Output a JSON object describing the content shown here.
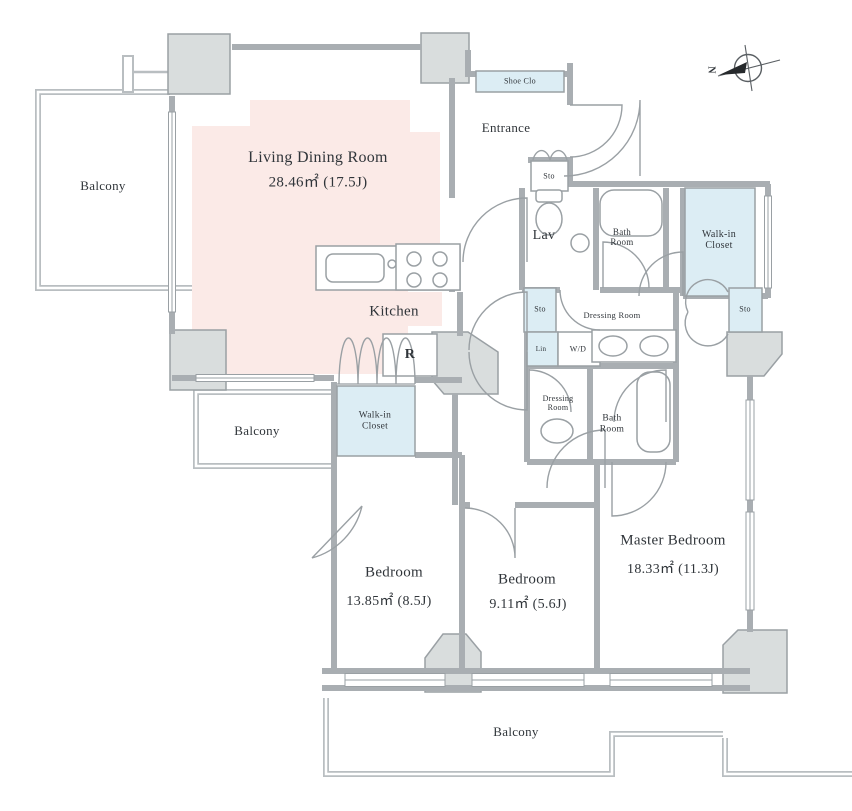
{
  "compass": {
    "north_label": "N"
  },
  "rooms": {
    "living_dining": {
      "name": "Living Dining Room",
      "area": "28.46㎡ (17.5J)"
    },
    "kitchen": {
      "name": "Kitchen"
    },
    "refrigerator": {
      "name": "R"
    },
    "entrance": {
      "name": "Entrance"
    },
    "shoe_closet": {
      "name": "Shoe Clo"
    },
    "lavatory": {
      "name": "Lav"
    },
    "bathroom_upper": {
      "name": "Bath Room"
    },
    "bathroom_lower": {
      "name": "Bath Room"
    },
    "walkin_closet_master": {
      "name": "Walk-in Closet"
    },
    "walkin_closet_bedroom": {
      "name": "Walk-in Closet"
    },
    "dressing_room_upper": {
      "name": "Dressing Room"
    },
    "dressing_room_lower": {
      "name": "Dressing Room"
    },
    "linen": {
      "name": "Lin"
    },
    "washer_dryer": {
      "name": "W/D"
    },
    "storage_entrance": {
      "name": "Sto"
    },
    "storage_hall": {
      "name": "Sto"
    },
    "storage_master": {
      "name": "Sto"
    },
    "bedroom_1": {
      "name": "Bedroom",
      "area": "13.85㎡ (8.5J)"
    },
    "bedroom_2": {
      "name": "Bedroom",
      "area": "9.11㎡ (5.6J)"
    },
    "master_bedroom": {
      "name": "Master Bedroom",
      "area": "18.33㎡ (11.3J)"
    },
    "balcony_left": {
      "name": "Balcony"
    },
    "balcony_middle": {
      "name": "Balcony"
    },
    "balcony_bottom": {
      "name": "Balcony"
    }
  },
  "colors": {
    "floor_pink": "#fbeae7",
    "closet_blue": "#dcedf4",
    "wall_gray": "#a9aeb2",
    "pillar_gray": "#d9dddd",
    "rail_gray": "#b9bec1"
  }
}
